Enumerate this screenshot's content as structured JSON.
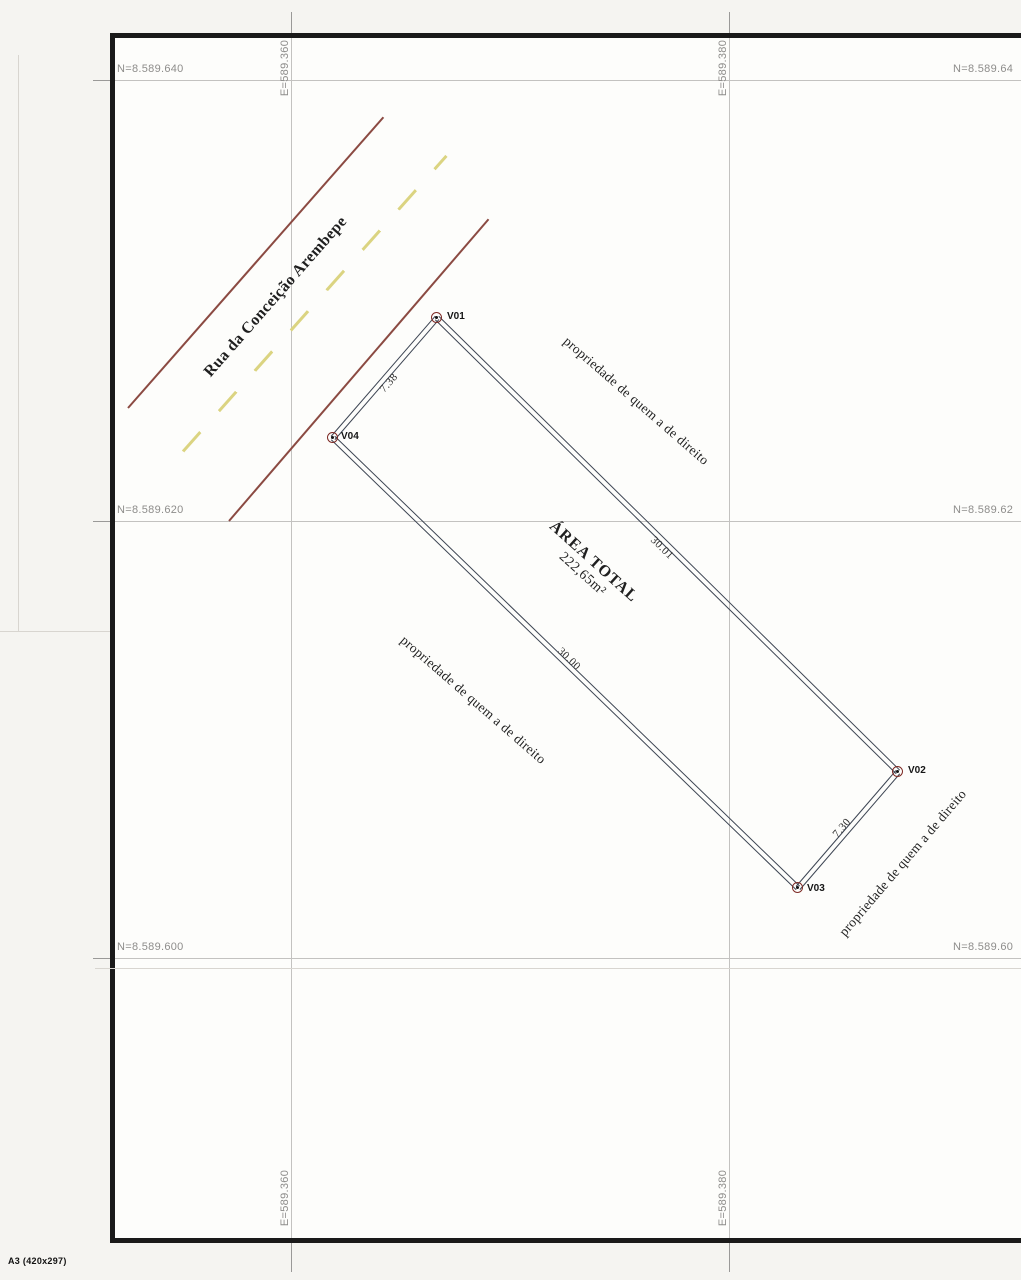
{
  "sheet": {
    "format": "A3 (420x297)"
  },
  "street": {
    "name": "Rua da Conceição Arembepe"
  },
  "grid": {
    "n640_left": "N=8.589.640",
    "n640_right": "N=8.589.64",
    "n620_left": "N=8.589.620",
    "n620_right": "N=8.589.62",
    "n600_left": "N=8.589.600",
    "n600_right": "N=8.589.60",
    "e360_top": "E=589.360",
    "e360_bottom": "E=589.360",
    "e380_top": "E=589.380",
    "e380_bottom": "E=589.380"
  },
  "parcel": {
    "area_title": "ÁREA TOTAL",
    "area_value": "222,65m²",
    "vertices": {
      "v01": "V01",
      "v02": "V02",
      "v03": "V03",
      "v04": "V04"
    },
    "dimensions": {
      "front": "7.38",
      "side_ne": "30.01",
      "side_sw": "30.00",
      "rear": "7.30"
    }
  },
  "neighbors": {
    "label": "propriedade de quem a de direito"
  },
  "colors": {
    "street_edge": "#8b4a42",
    "street_centerline": "#dbd481",
    "parcel_edge": "#3c4452",
    "vertex_ring": "#7e2b26",
    "grid_line": "#c3c2c0",
    "frame_border": "#1a1a1a"
  }
}
